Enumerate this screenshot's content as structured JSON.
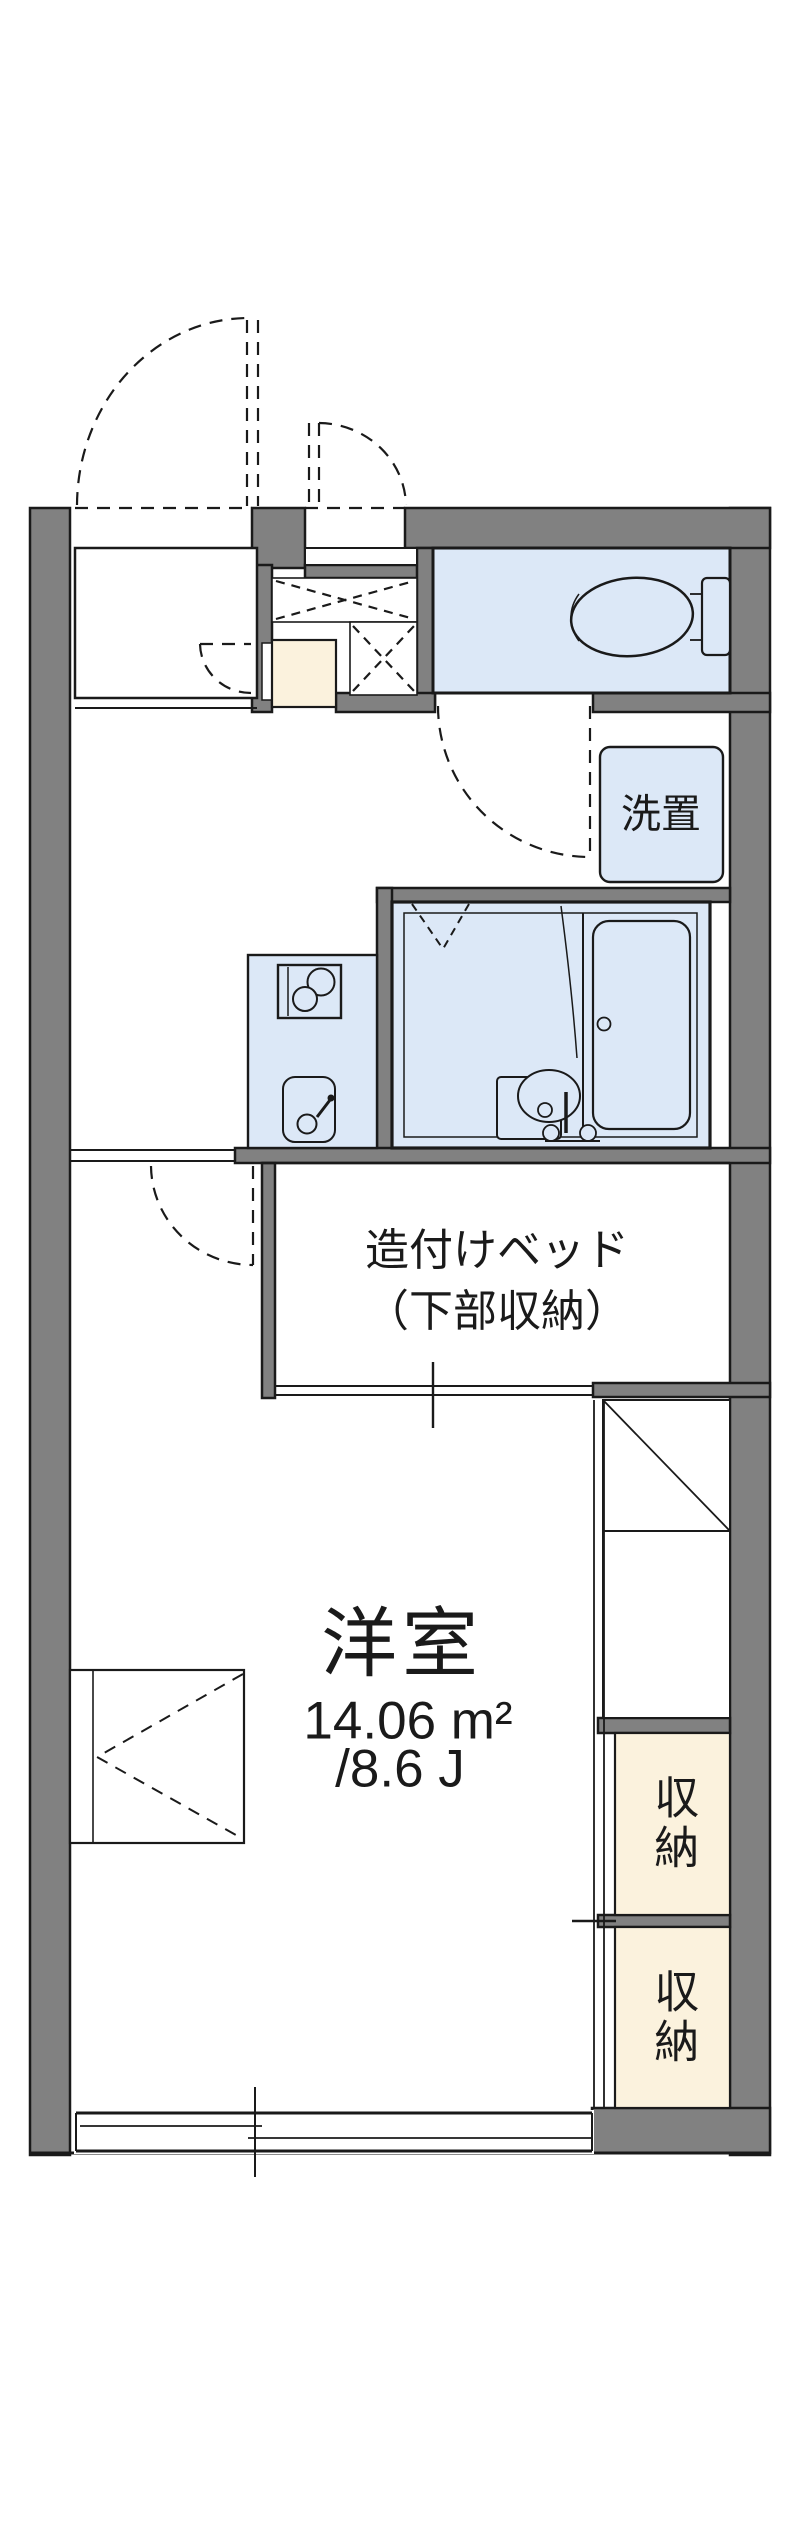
{
  "floorplan": {
    "colors": {
      "wall": "#818181",
      "water": "#dce8f7",
      "storage": "#fbf2dd",
      "line": "#1a1a1a",
      "bg": "#ffffff"
    },
    "labels": {
      "laundry": "洗置",
      "bed_line1": "造付けベッド",
      "bed_line2": "（下部収納）",
      "room_name": "洋室",
      "area_sqm": "14.06 m²",
      "area_jo": "/8.6 J",
      "storage_upper": "収納",
      "storage_lower": "収納"
    },
    "room": {
      "name": "洋室",
      "area_sqm": 14.06,
      "area_tatami": 8.6
    },
    "fixtures": [
      "toilet-icon",
      "bathtub-icon",
      "washbasin-icon",
      "stove-icon",
      "kitchen-sink-icon",
      "washing-machine-space",
      "built-in-bed",
      "refrigerator-space",
      "casement-window",
      "sliding-window",
      "entrance-door-swing",
      "interior-door-swing"
    ]
  }
}
